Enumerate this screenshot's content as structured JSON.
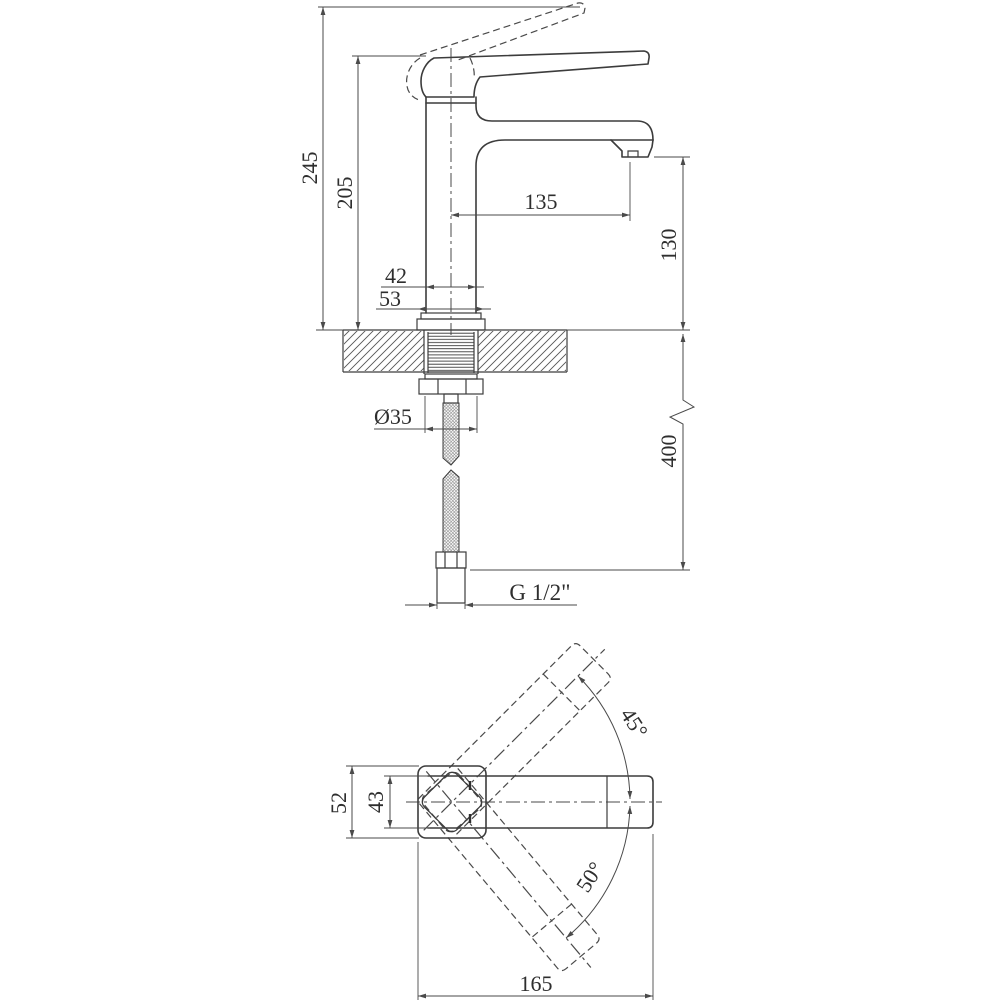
{
  "drawing": {
    "background": "#ffffff",
    "line_color": "#3c3c3c",
    "views": {
      "side": {
        "overall_height": "245",
        "handle_height": "205",
        "spout_reach": "135",
        "spout_outlet_height": "130",
        "body_width": "42",
        "base_width": "53",
        "mounting_diameter": "Ø35",
        "hose_length": "400",
        "connection_thread": "G 1/2\""
      },
      "top": {
        "base_depth": "52",
        "handle_width": "43",
        "handle_swing_up": "45°",
        "handle_swing_down": "50°",
        "overall_length": "165"
      }
    }
  }
}
